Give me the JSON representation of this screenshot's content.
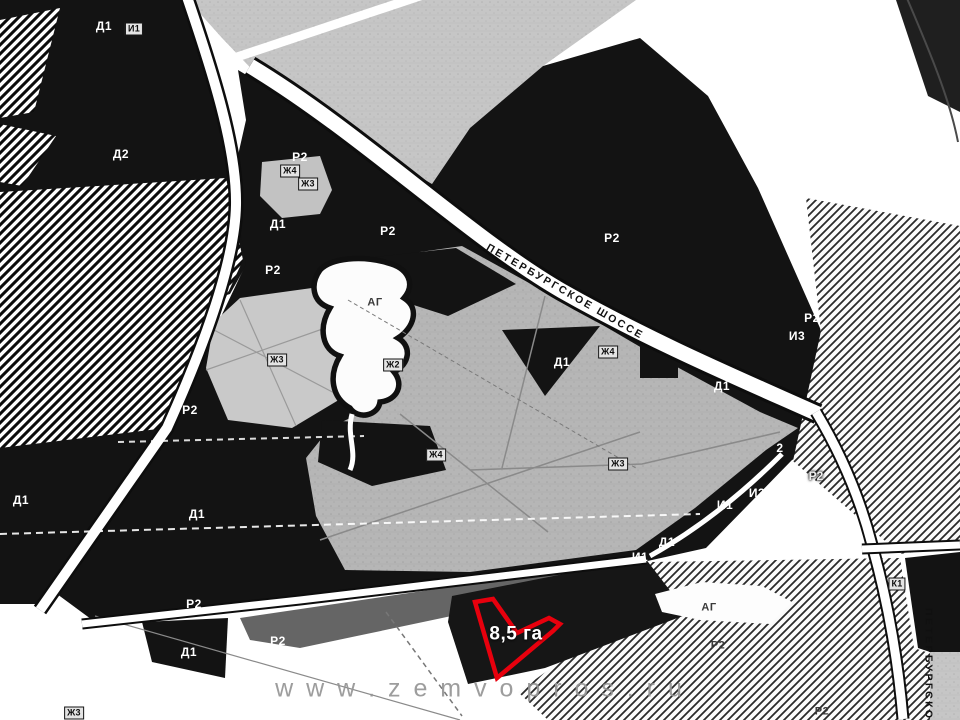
{
  "map": {
    "watermark": {
      "text": "w w w . z e m v o p r o s . r u",
      "x": 480,
      "y": 689
    },
    "parcel": {
      "area_label": "8,5 га",
      "x": 516,
      "y": 634,
      "outline_color": "#e8000d"
    },
    "roads": [
      {
        "name": "ПЕТЕРБУРГСКОЕ ШОССЕ",
        "x": 565,
        "y": 292,
        "rotation": 30
      },
      {
        "name": "ПЕТЕРБУРГСКОЕ Ш",
        "x": 928,
        "y": 678,
        "rotation": 90
      }
    ],
    "zone_labels": [
      {
        "text": "Д1",
        "x": 104,
        "y": 26,
        "style": "zone-dark"
      },
      {
        "text": "И1",
        "x": 134,
        "y": 29,
        "style": "zone-box"
      },
      {
        "text": "Д2",
        "x": 121,
        "y": 154,
        "style": "zone-dark"
      },
      {
        "text": "Р2",
        "x": 300,
        "y": 157,
        "style": "zone-dark"
      },
      {
        "text": "Ж4",
        "x": 290,
        "y": 171,
        "style": "zone-box"
      },
      {
        "text": "Ж3",
        "x": 308,
        "y": 184,
        "style": "zone-box"
      },
      {
        "text": "Д1",
        "x": 278,
        "y": 224,
        "style": "zone-dark"
      },
      {
        "text": "Р2",
        "x": 388,
        "y": 231,
        "style": "zone-dark"
      },
      {
        "text": "Р2",
        "x": 612,
        "y": 238,
        "style": "zone-dark"
      },
      {
        "text": "Р2",
        "x": 273,
        "y": 270,
        "style": "zone-dark"
      },
      {
        "text": "АГ",
        "x": 375,
        "y": 303,
        "style": "zone-light"
      },
      {
        "text": "Ж3",
        "x": 277,
        "y": 360,
        "style": "zone-box"
      },
      {
        "text": "Ж2",
        "x": 393,
        "y": 365,
        "style": "zone-box"
      },
      {
        "text": "Д1",
        "x": 562,
        "y": 362,
        "style": "zone-dark"
      },
      {
        "text": "Ж4",
        "x": 608,
        "y": 352,
        "style": "zone-box"
      },
      {
        "text": "Д1",
        "x": 722,
        "y": 386,
        "style": "zone-dark"
      },
      {
        "text": "И3",
        "x": 797,
        "y": 336,
        "style": "zone-dark"
      },
      {
        "text": "Р2",
        "x": 812,
        "y": 318,
        "style": "zone-dark"
      },
      {
        "text": "Р2",
        "x": 190,
        "y": 410,
        "style": "zone-dark"
      },
      {
        "text": "Ж4",
        "x": 436,
        "y": 455,
        "style": "zone-box"
      },
      {
        "text": "Ж3",
        "x": 618,
        "y": 464,
        "style": "zone-box"
      },
      {
        "text": "2",
        "x": 780,
        "y": 448,
        "style": "zone-dark"
      },
      {
        "text": "Р2",
        "x": 816,
        "y": 476,
        "style": "zone-outline"
      },
      {
        "text": "И3",
        "x": 757,
        "y": 493,
        "style": "zone-dark"
      },
      {
        "text": "И1",
        "x": 725,
        "y": 505,
        "style": "zone-dark"
      },
      {
        "text": "Д1",
        "x": 667,
        "y": 542,
        "style": "zone-dark"
      },
      {
        "text": "И1",
        "x": 640,
        "y": 557,
        "style": "zone-dark"
      },
      {
        "text": "Д1",
        "x": 21,
        "y": 500,
        "style": "zone-dark"
      },
      {
        "text": "Д1",
        "x": 197,
        "y": 514,
        "style": "zone-dark"
      },
      {
        "text": "Р2",
        "x": 194,
        "y": 604,
        "style": "zone-dark"
      },
      {
        "text": "Д1",
        "x": 189,
        "y": 652,
        "style": "zone-dark"
      },
      {
        "text": "Р2",
        "x": 278,
        "y": 641,
        "style": "zone-dark"
      },
      {
        "text": "АГ",
        "x": 709,
        "y": 608,
        "style": "zone-light"
      },
      {
        "text": "Р2",
        "x": 718,
        "y": 646,
        "style": "zone-light"
      },
      {
        "text": "Р2",
        "x": 822,
        "y": 712,
        "style": "zone-light"
      },
      {
        "text": "К1",
        "x": 897,
        "y": 584,
        "style": "zone-box"
      },
      {
        "text": "Ж3",
        "x": 74,
        "y": 713,
        "style": "zone-box"
      }
    ],
    "colors": {
      "map_black": "#131313",
      "field_gray": "#b6b6b6",
      "parcel_red": "#e8000d"
    }
  }
}
